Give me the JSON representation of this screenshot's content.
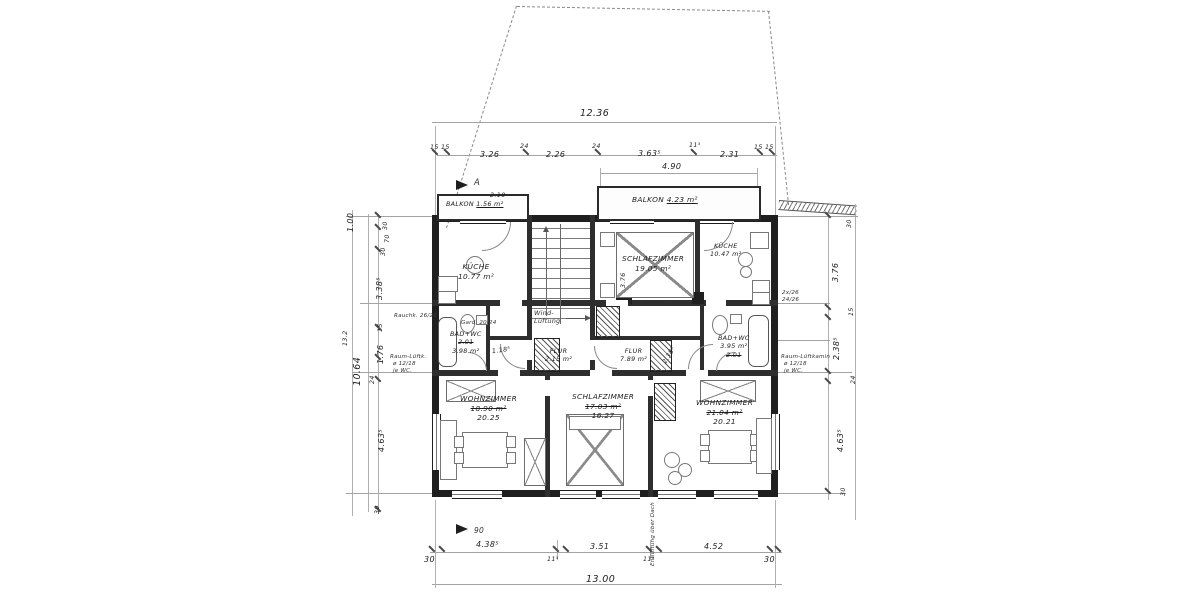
{
  "colors": {
    "ink": "#1f1f1f",
    "faint": "#a3a3a3",
    "hand": "#333333",
    "paper": "#ffffff"
  },
  "rooms": [
    {
      "name": "BALKON",
      "area": "1.56 m²"
    },
    {
      "name": "KÜCHE",
      "area": "10.77 m²"
    },
    {
      "name": "SCHLAFZIMMER",
      "area": "19.05 m²"
    },
    {
      "name": "KÜCHE",
      "area": "10.47 m²"
    },
    {
      "name": "BALKON",
      "area": "4.23 m²"
    },
    {
      "name": "BAD+WC",
      "area": "3.98 m²",
      "alt": "2.01"
    },
    {
      "name": "BAD+WC",
      "area": "3.95 m²",
      "alt": "2.01"
    },
    {
      "name": "FLUR",
      "area": "2.15 m²"
    },
    {
      "name": "FLUR",
      "area": "7.89 m²"
    },
    {
      "name": "WOHNZIMMER",
      "area_old": "18.90 m²",
      "area_new": "20.25"
    },
    {
      "name": "SCHLAFZIMMER",
      "area_old": "17.03 m²",
      "area_new": "16.27"
    },
    {
      "name": "WOHNZIMMER",
      "area_old": "21.04 m²",
      "area_new": "20.21"
    }
  ],
  "dims": {
    "top_total": "12.36",
    "top": [
      "15",
      "15",
      "3.26",
      "24",
      "2.26",
      "24",
      "3.63⁵",
      "11⁵",
      "2.31",
      "15",
      "15"
    ],
    "balcony_width": "4.90",
    "balcony_small_width": "2.10",
    "bottom": [
      "30",
      "4.38⁵",
      "11⁵",
      "3.51",
      "11⁵",
      "4.52",
      "30"
    ],
    "bottom_total": "13.00",
    "left": [
      "1.00",
      "30",
      "70",
      "30",
      "3.38⁵",
      "15",
      "1.76",
      "24",
      "4.63⁵",
      "30"
    ],
    "left_total": "10.64",
    "left_outer": "13.2",
    "right": [
      "30",
      "3.76",
      "15",
      "2.38⁵",
      "24",
      "4.63⁵",
      "30"
    ],
    "inner_height": "3.76",
    "inner_diag": "2.38⁵",
    "bad_width": "1.18⁵"
  },
  "annotations": {
    "rauchk": "Rauchk. 26/26",
    "gard": "Gard. 20/24",
    "vent_left": [
      "Raum-Lüftk.",
      "ø 12/18",
      "je WC."
    ],
    "vent_right": [
      "Raum-Lüftkamin",
      "ø 12/18",
      "je WC."
    ],
    "wind": [
      "Wind-",
      "Lüftung"
    ],
    "flue_a": "26/26",
    "flue_b": "24/26",
    "flue_right": [
      "2x/26",
      "24/26"
    ],
    "duct": "Entlüftung über Dach",
    "marker_a": "A",
    "door_width": "90"
  }
}
